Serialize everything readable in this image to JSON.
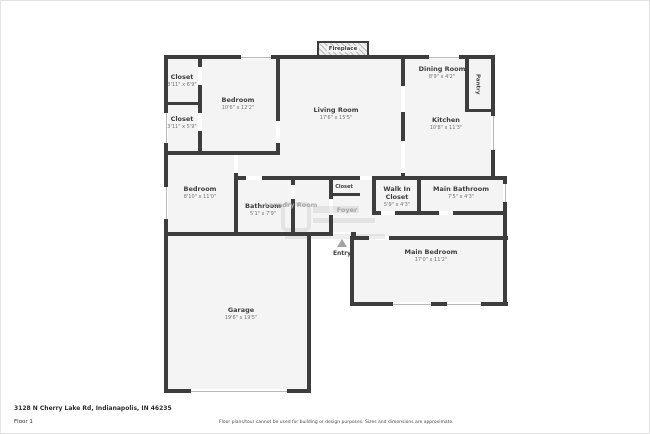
{
  "meta": {
    "address": "3128 N Cherry Lake Rd, Indianapolis, IN 46235",
    "floor_label": "Floor 1",
    "disclaimer": "Floor plans/tour cannot be used for building or design purposes. Sizes and dimensions are approximate."
  },
  "colors": {
    "wall": "#3d3d3d",
    "room_fill": "#f4f4f4",
    "label": "#3e3e3e",
    "dims": "#757575",
    "window": "#b9b9b9",
    "entry_arrow": "#a3a3a3"
  },
  "rooms": [
    {
      "id": "closet-upper",
      "label": "Closet",
      "dims": "3'11\" x 6'9\""
    },
    {
      "id": "closet-lower",
      "label": "Closet",
      "dims": "3'11\" x 5'9\""
    },
    {
      "id": "bedroom-front",
      "label": "Bedroom",
      "dims": "10'6\" x 12'2\""
    },
    {
      "id": "living-room",
      "label": "Living Room",
      "dims": "17'6\" x 15'5\""
    },
    {
      "id": "dining-room",
      "label": "Dining Room",
      "dims": "8'9\" x 4'2\""
    },
    {
      "id": "pantry",
      "label": "Pantry",
      "dims": ""
    },
    {
      "id": "kitchen",
      "label": "Kitchen",
      "dims": "10'8\" x 11'3\""
    },
    {
      "id": "bedroom-middle",
      "label": "Bedroom",
      "dims": "8'10\" x 11'0\""
    },
    {
      "id": "bathroom",
      "label": "Bathroom",
      "dims": "5'1\" x 7'9\""
    },
    {
      "id": "laundry",
      "label": "Laundry Room",
      "dims": ""
    },
    {
      "id": "closet-center",
      "label": "Closet",
      "dims": ""
    },
    {
      "id": "walk-in-closet",
      "label": "Walk In Closet",
      "dims": "5'9\" x 4'3\""
    },
    {
      "id": "main-bathroom",
      "label": "Main Bathroom",
      "dims": "7'5\" x 4'3\""
    },
    {
      "id": "foyer",
      "label": "Foyer",
      "dims": ""
    },
    {
      "id": "main-bedroom",
      "label": "Main Bedroom",
      "dims": "17'0\" x 11'2\""
    },
    {
      "id": "garage",
      "label": "Garage",
      "dims": "19'6\" x 19'5\""
    },
    {
      "id": "fireplace",
      "label": "Fireplace",
      "dims": ""
    },
    {
      "id": "entry",
      "label": "Entry",
      "dims": ""
    }
  ]
}
